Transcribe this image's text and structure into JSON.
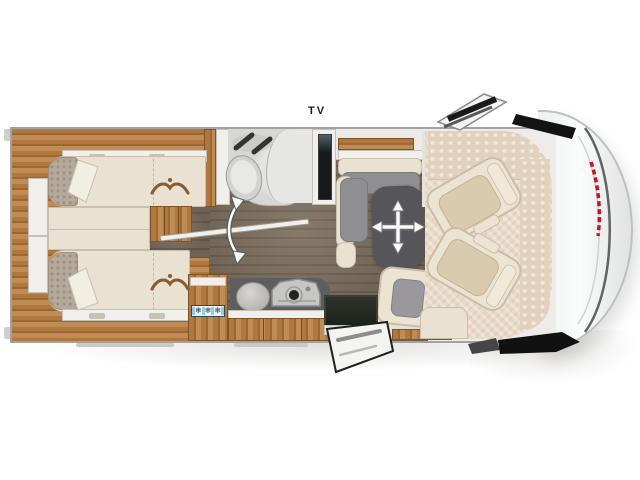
{
  "labels": {
    "tv": "TV"
  },
  "kitchen": {
    "fridge": {
      "snowflakes": [
        "❄",
        "❄",
        "❄"
      ]
    }
  },
  "icons": {
    "table_move": "four-way-move-arrows",
    "bathroom_door_swing": "double-curved-swing-arrow",
    "fridge_marker": "snowflake",
    "bed_emblem": "curved-stitch-with-dot"
  },
  "colors": {
    "wall": "#a3a2a0",
    "wood": "#b0783e",
    "wood_dark": "#9c6730",
    "wood_light": "#c08c56",
    "floor": "#6e6254",
    "cream": "#e9e1d1",
    "white_furn": "#f1efeb",
    "gray_cushion": "#8f8e92",
    "table": "#56565a",
    "pillow": "#b5a99a",
    "carpet": "#e9dac8",
    "dash": "#e2d1bd",
    "dark_step": "#262c24",
    "screen": "#17191b",
    "snow_panel": "#eef6fa",
    "snow_tick": "#8fd0e8",
    "snowflake": "#1c2a30",
    "decal_red": "#cc1126",
    "nose": "#f6f8f7",
    "mirror_black": "#131313",
    "pod": "#d7d7d5"
  }
}
